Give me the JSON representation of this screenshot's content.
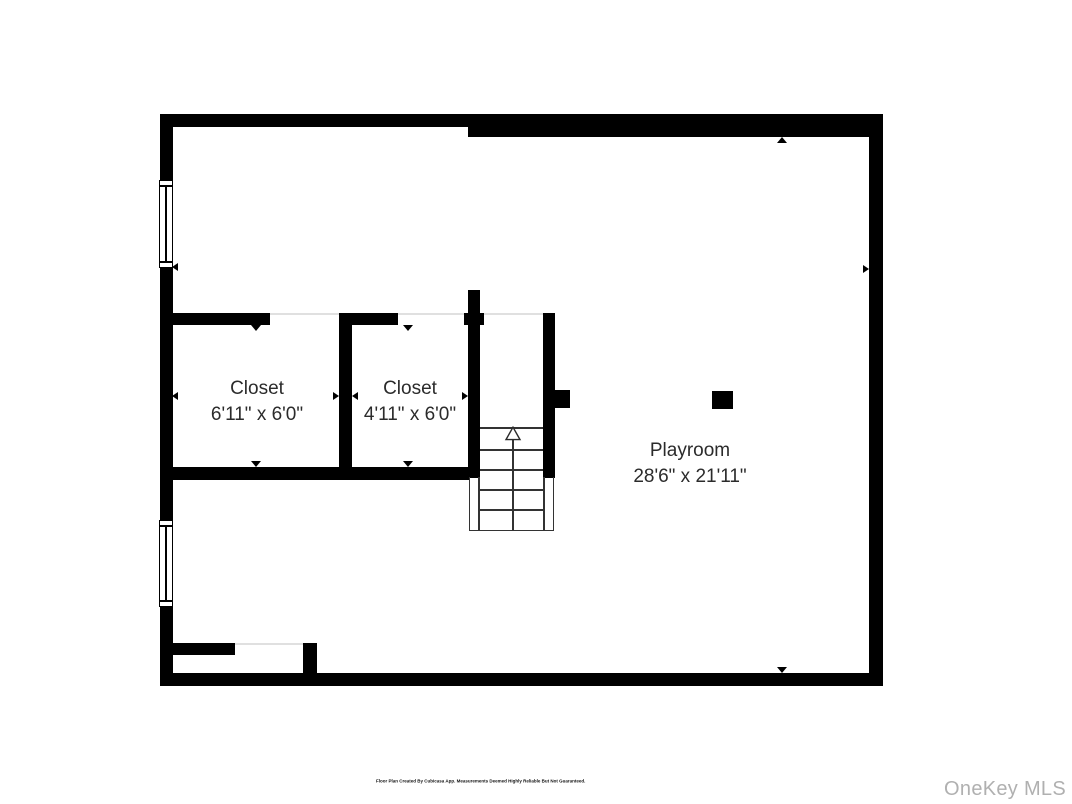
{
  "floorplan": {
    "rooms": [
      {
        "name": "Closet",
        "dims": "6'11\" x 6'0\""
      },
      {
        "name": "Closet",
        "dims": "4'11\" x 6'0\""
      },
      {
        "name": "Playroom",
        "dims": "28'6\" x 21'11\""
      }
    ],
    "colors": {
      "wall": "#000000",
      "background": "#ffffff",
      "label_text": "#2b2b2b",
      "stair_line": "#333333",
      "threshold_line": "#e0e0e0"
    }
  },
  "footer": {
    "disclaimer": "Floor Plan Created By Cubicasa App. Measurements Deemed Highly Reliable But Not Guaranteed."
  },
  "watermark": {
    "text": "OneKey MLS",
    "color": "#b0b0b0"
  }
}
